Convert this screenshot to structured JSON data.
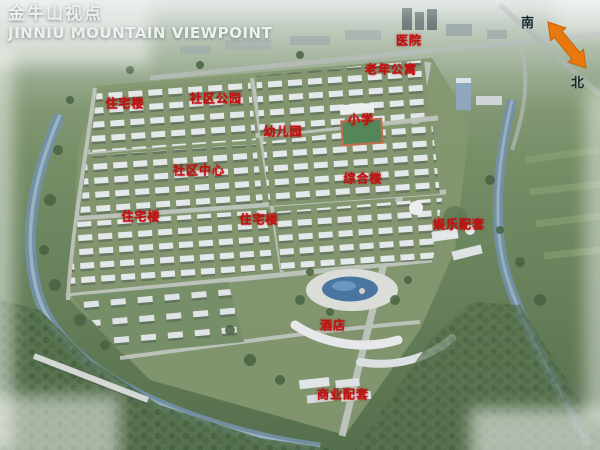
{
  "title": {
    "cn": "金牛山视点",
    "en": "JINNIU MOUNTAIN VIEWPOINT"
  },
  "compass": {
    "south": "南",
    "north": "北"
  },
  "map_labels": [
    {
      "id": "hospital",
      "text": "医院"
    },
    {
      "id": "senior-apartments",
      "text": "老年公寓"
    },
    {
      "id": "residential-northwest",
      "text": "住宅楼"
    },
    {
      "id": "community-park",
      "text": "社区公园"
    },
    {
      "id": "kindergarten",
      "text": "幼儿园"
    },
    {
      "id": "primary-school",
      "text": "小学"
    },
    {
      "id": "community-center",
      "text": "社区中心"
    },
    {
      "id": "mixed-use-building",
      "text": "综合楼"
    },
    {
      "id": "residential-west",
      "text": "住宅楼"
    },
    {
      "id": "residential-central",
      "text": "住宅楼"
    },
    {
      "id": "entertainment-facilities",
      "text": "娱乐配套"
    },
    {
      "id": "hotel",
      "text": "酒店"
    },
    {
      "id": "commercial-facilities",
      "text": "商业配套"
    }
  ],
  "colors": {
    "label_red": "#c31212",
    "compass_orange": "#e8790f",
    "title_white": "#eef2ef",
    "river_blue": "#6d8ba3",
    "lake_blue": "#3f6f9e"
  }
}
